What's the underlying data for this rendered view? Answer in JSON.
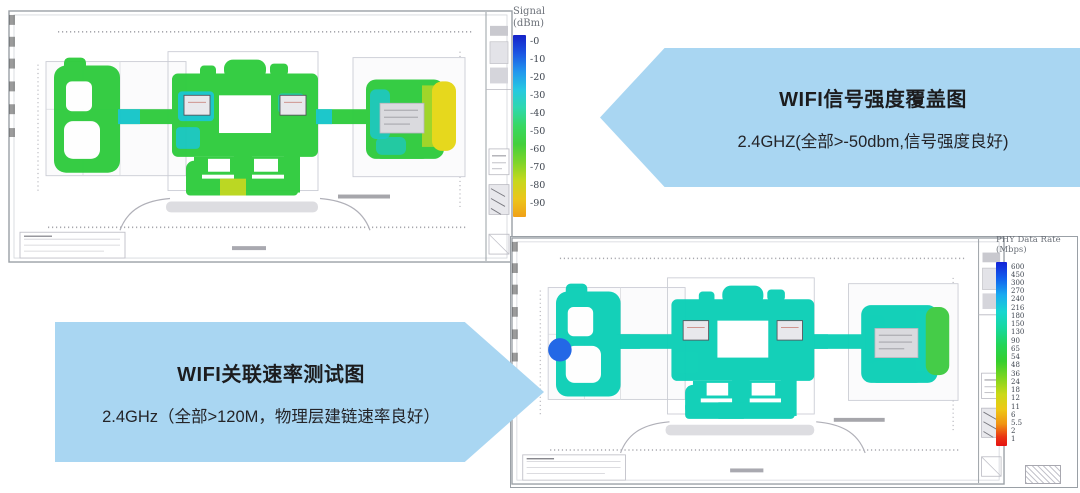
{
  "page": {
    "background": "#ffffff"
  },
  "banners": {
    "signal": {
      "title": "WIFI信号强度覆盖图",
      "subtitle": "2.4GHZ(全部>-50dbm,信号强度良好)",
      "direction": "left",
      "fill_color": "#a9d6f2"
    },
    "rate": {
      "title": "WIFI关联速率测试图",
      "subtitle": "2.4GHz（全部>120M，物理层建链速率良好）",
      "direction": "right",
      "fill_color": "#a9d6f2"
    }
  },
  "heatmaps": {
    "signal": {
      "colorbar_title": "Signal",
      "colorbar_unit": "(dBm)",
      "ticks": [
        "-0",
        "-10",
        "-20",
        "-30",
        "-40",
        "-50",
        "-60",
        "-70",
        "-80",
        "-90"
      ],
      "dominant_color": "#2ecb3d",
      "accent_colors": {
        "cyan_patch": "#14c5c9",
        "yellow_endcap": "#e6d714",
        "yellow_green": "#b9d61b"
      }
    },
    "phy": {
      "colorbar_title": "PHY Data Rate",
      "colorbar_unit": "(Mbps)",
      "ticks": [
        "600",
        "450",
        "300",
        "270",
        "240",
        "216",
        "180",
        "150",
        "130",
        "90",
        "65",
        "54",
        "48",
        "36",
        "24",
        "18",
        "12",
        "11",
        "6",
        "5.5",
        "2",
        "1"
      ],
      "dominant_color": "#0bcfb6",
      "accent_colors": {
        "blue_blob": "#1b63e6",
        "green_endcap": "#3ecb41"
      }
    }
  }
}
